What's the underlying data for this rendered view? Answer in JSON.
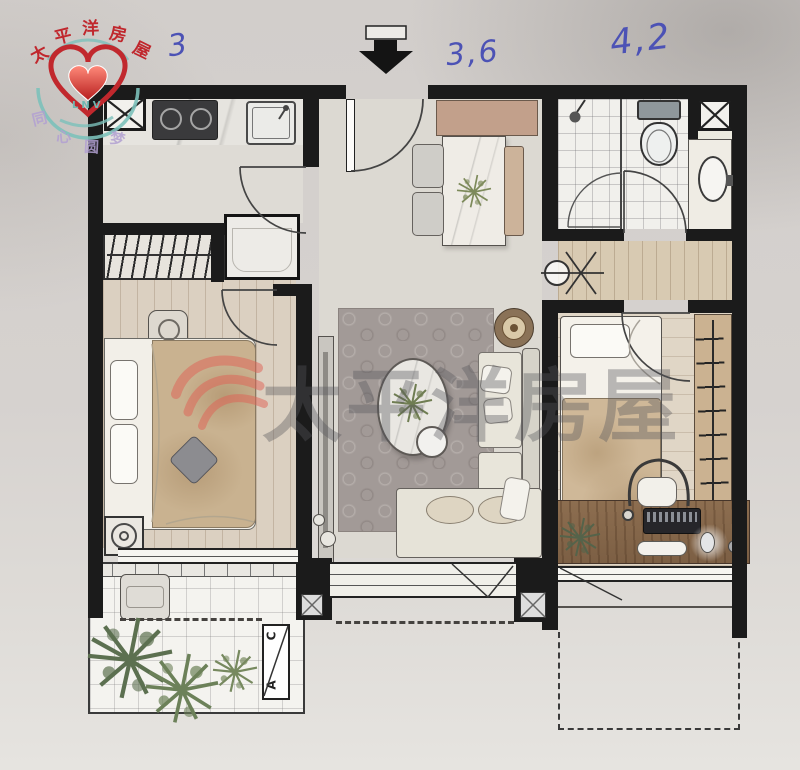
{
  "brand": {
    "chars": [
      "太",
      "平",
      "洋",
      "房",
      "屋"
    ],
    "subtext": "LNV",
    "slogan_chars": [
      "同",
      "心",
      "圆",
      "梦"
    ]
  },
  "annotations": {
    "kitchen_width": "3",
    "living_width": "3,6",
    "right_width": "4,2"
  },
  "watermark": {
    "text": "太平洋房屋"
  },
  "balcony_marker": {
    "top": "C",
    "bottom": "A"
  },
  "colors": {
    "paper": "#d6d2cf",
    "wall": "#1b1b1b",
    "ink_blue": "#4c52b5",
    "brand_red": "#c0272d",
    "brand_teal": "#74bdb6",
    "slogan_purple": "#b2a0d2",
    "wood_floor": "#dbd0c1",
    "desk_wood": "#8d6e50",
    "blanket_tan": "#c9b290",
    "rug_gray": "#a39b97",
    "plant_green": "#5f7352"
  }
}
